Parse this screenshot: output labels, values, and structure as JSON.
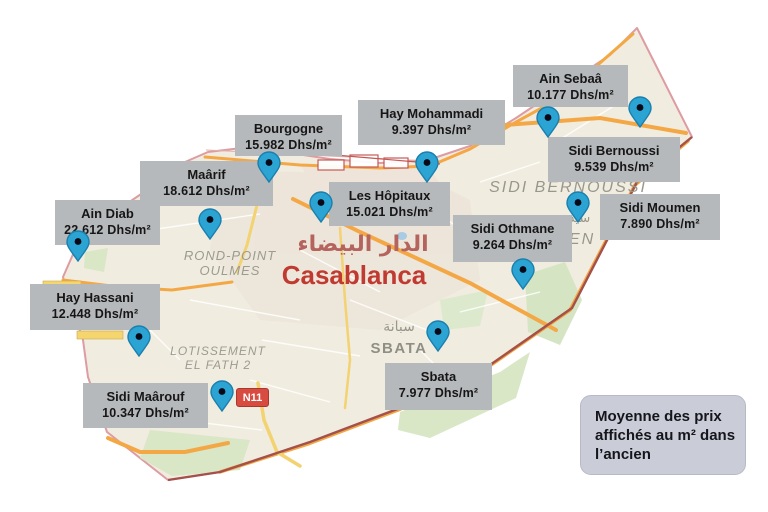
{
  "legend": {
    "line1": "Moyenne des prix",
    "line2": "affichés au m² dans",
    "line3": "l’ancien"
  },
  "map": {
    "labels": {
      "city_ar": "الدار البيضاء",
      "city_en": "Casablanca",
      "rond_point_line1": "ROND-POINT",
      "rond_point_line2": "OULMES",
      "lotissement_line1": "LOTISSEMENT",
      "lotissement_line2": "EL FATH 2",
      "sbata_ar": "سبانة",
      "sbata": "SBATA",
      "sidi_bernoussi": "SIDI BERNOUSSI",
      "sidi_moumen": "SIDI MOUMEN",
      "sidi_moumen_ar": "سيدي مومن",
      "road_badge": "N11"
    },
    "colors": {
      "pin_fill": "#2ba4d4",
      "pin_stroke": "#1a7fad",
      "label_box_bg": "#b6b9bb",
      "legend_bg": "#cacdd7",
      "city_red": "#c03a31",
      "boundary_pink": "#dd9ca1",
      "boundary_maroon": "#a3514a",
      "road_orange": "#f3a845"
    },
    "markers": [
      {
        "name": "Ain Diab",
        "price": "22.612 Dhs/m²",
        "box": {
          "x": 55,
          "y": 200,
          "w": 105,
          "h": 45
        },
        "pin": {
          "x": 78,
          "y": 241
        }
      },
      {
        "name": "Hay Hassani",
        "price": "12.448 Dhs/m²",
        "box": {
          "x": 30,
          "y": 284,
          "w": 130,
          "h": 46
        },
        "pin": {
          "x": 139,
          "y": 336
        }
      },
      {
        "name": "Sidi Maârouf",
        "price": "10.347 Dhs/m²",
        "box": {
          "x": 83,
          "y": 383,
          "w": 125,
          "h": 45
        },
        "pin": {
          "x": 222,
          "y": 391
        }
      },
      {
        "name": "Maârif",
        "price": "18.612 Dhs/m²",
        "box": {
          "x": 140,
          "y": 161,
          "w": 133,
          "h": 45
        },
        "pin": {
          "x": 210,
          "y": 219
        }
      },
      {
        "name": "Bourgogne",
        "price": "15.982 Dhs/m²",
        "box": {
          "x": 235,
          "y": 115,
          "w": 107,
          "h": 41
        },
        "pin": {
          "x": 269,
          "y": 162
        }
      },
      {
        "name": "Les Hôpitaux",
        "price": "15.021 Dhs/m²",
        "box": {
          "x": 329,
          "y": 182,
          "w": 121,
          "h": 44
        },
        "pin": {
          "x": 321,
          "y": 202
        }
      },
      {
        "name": "Hay Mohammadi",
        "price": "9.397 Dhs/m²",
        "box": {
          "x": 358,
          "y": 100,
          "w": 147,
          "h": 45
        },
        "pin": {
          "x": 427,
          "y": 162
        }
      },
      {
        "name": "Sbata",
        "price": "7.977 Dhs/m²",
        "box": {
          "x": 385,
          "y": 363,
          "w": 107,
          "h": 47
        },
        "pin": {
          "x": 438,
          "y": 331
        }
      },
      {
        "name": "Sidi Othmane",
        "price": "9.264 Dhs/m²",
        "box": {
          "x": 453,
          "y": 215,
          "w": 119,
          "h": 47
        },
        "pin": {
          "x": 523,
          "y": 269
        }
      },
      {
        "name": "Ain Sebaâ",
        "price": "10.177 Dhs/m²",
        "box": {
          "x": 513,
          "y": 65,
          "w": 115,
          "h": 42
        },
        "pin": {
          "x": 548,
          "y": 117
        }
      },
      {
        "name": "Sidi Bernoussi",
        "price": "9.539 Dhs/m²",
        "box": {
          "x": 548,
          "y": 137,
          "w": 132,
          "h": 45
        },
        "pin": {
          "x": 640,
          "y": 107
        }
      },
      {
        "name": "Sidi Moumen",
        "price": "7.890 Dhs/m²",
        "box": {
          "x": 600,
          "y": 194,
          "w": 120,
          "h": 46
        },
        "pin": {
          "x": 578,
          "y": 202
        }
      }
    ]
  }
}
